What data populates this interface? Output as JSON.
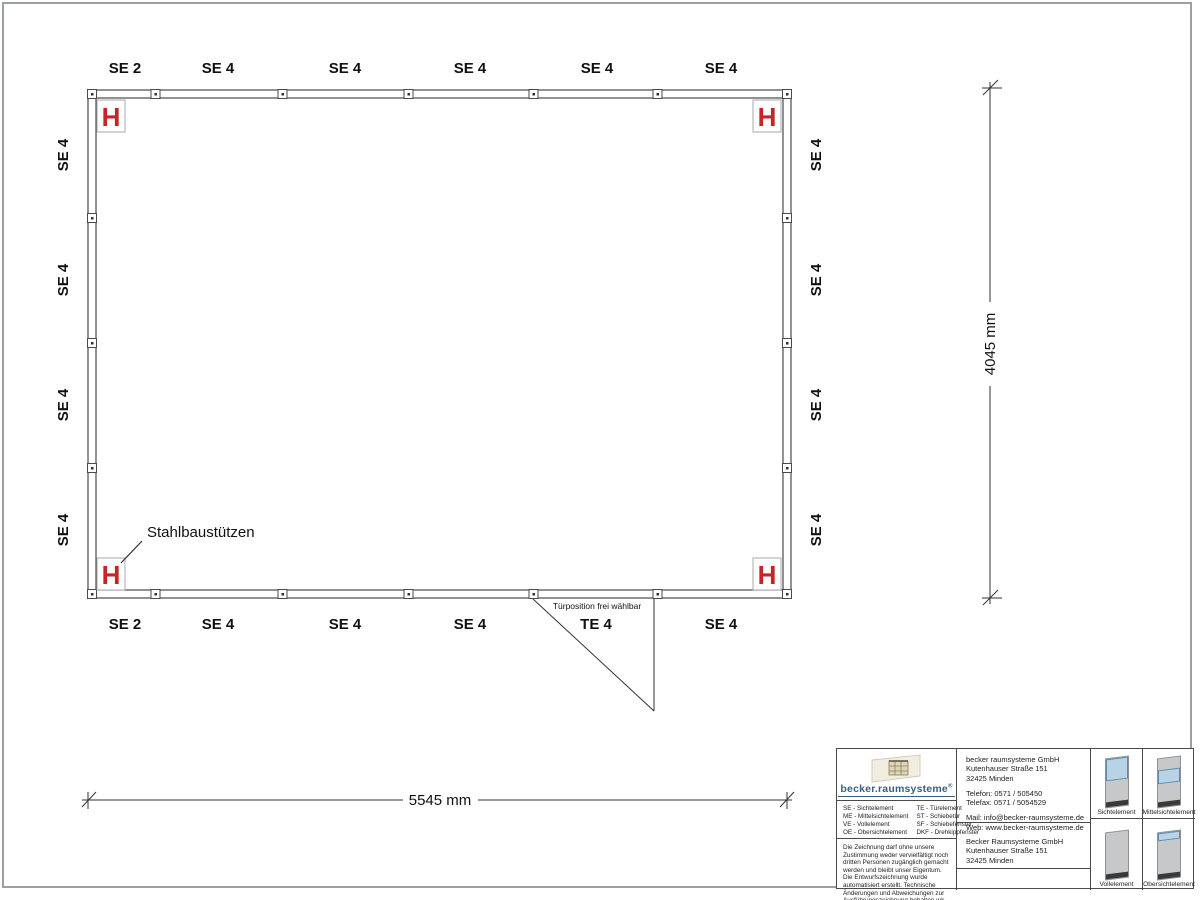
{
  "plan": {
    "top_labels": [
      "SE 2",
      "SE 4",
      "SE 4",
      "SE 4",
      "SE 4",
      "SE 4"
    ],
    "bottom_labels": [
      "SE 2",
      "SE 4",
      "SE 4",
      "SE 4",
      "TE 4",
      "SE 4"
    ],
    "left_labels": [
      "SE 4",
      "SE 4",
      "SE 4",
      "SE 4"
    ],
    "right_labels": [
      "SE 4",
      "SE 4",
      "SE 4",
      "SE 4"
    ],
    "column_symbol": "H",
    "column_annotation": "Stahlbaustützen",
    "door_note": "Türposition frei wählbar"
  },
  "dimensions": {
    "width_label": "5545 mm",
    "height_label": "4045 mm"
  },
  "title_block": {
    "logo_text": "becker.raumsysteme",
    "logo_registered": "®",
    "legend_col1": [
      "SE - Sichtelement",
      "ME - Mittelsichtelement",
      "VE - Vollelement",
      "OE - Obersichtelement"
    ],
    "legend_col2": [
      "TE - Türelement",
      "ST - Schiebetür",
      "SF - Schiebefenster",
      "DKF - Drehkippfenster"
    ],
    "disclaimer": "Die Zeichnung darf ohne unsere Zustimmung weder vervielfältigt noch dritten Personen zugänglich gemacht werden und bleibt unser Eigentum. Die Entwurfszeichnung wurde automatisiert erstellt. Technische Änderungen und Abweichungen zur Ausführungszeichnung behalten wir uns vor.",
    "contact": {
      "company": "becker raumsysteme GmbH",
      "street": "Kutenhauser Straße 151",
      "city": "32425 Minden",
      "phone": "Telefon: 0571 / 505450",
      "fax": "Telefax: 0571 / 5054529",
      "mail": "Mail: info@becker-raumsysteme.de",
      "web": "Web: www.becker-raumsysteme.de"
    },
    "address2": {
      "company": "Becker Raumsysteme GmbH",
      "street": "Kutenhauser Straße 151",
      "city": "32425 Minden"
    },
    "elements": [
      {
        "label": "Sichtelement"
      },
      {
        "label": "Mittelsichtelement"
      },
      {
        "label": "Vollelement"
      },
      {
        "label": "Obersichtelement"
      }
    ]
  },
  "colors": {
    "column_red": "#c22626",
    "logo_blue": "#3a5f80",
    "glass_blue": "#b9d3e6"
  }
}
